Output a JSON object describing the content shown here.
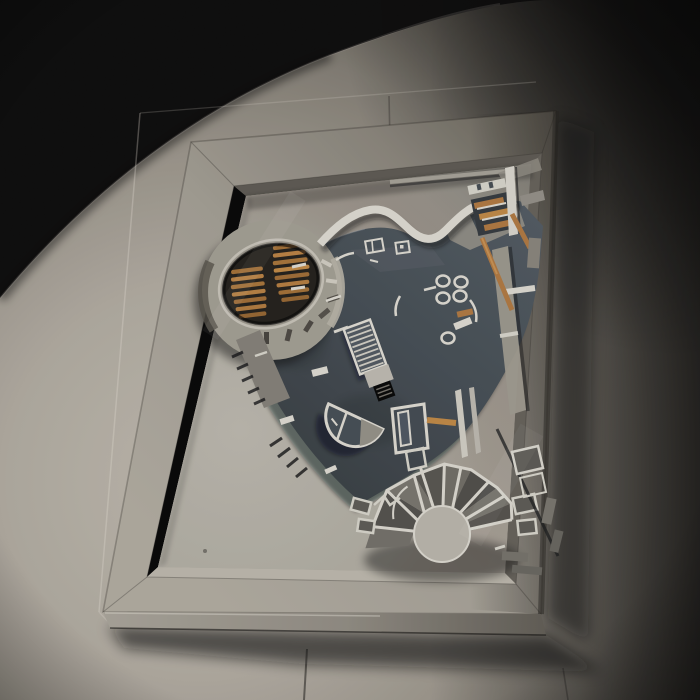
{
  "scene": {
    "type": "photograph",
    "subject": "architectural-scale-model-in-wall-mounted-display-case",
    "lighting": "single-spotlight-from-lower-left-dark-room"
  },
  "palette": {
    "bg": "#060505",
    "wall_bright": "#b7b1a6",
    "wall_mid": "#958f85",
    "wall_dark": "#161412",
    "frame_face": "#a9a499",
    "frame_face_dark": "#5d594f",
    "frame_bottom": "#9a958b",
    "bevel_light": "#b5b0a5",
    "bevel_dark": "#57534c",
    "mat_bright": "#b4b0a6",
    "mat_dark": "#7e7a72",
    "plate": "#3f474e",
    "plate_light": "#4b545c",
    "plate_dark": "#31373c",
    "model_white": "#d6d3ca",
    "model_gray": "#8b887f",
    "fan_gray": "#6c6963",
    "fan_dark": "#4c4a46",
    "orange": "#a8713a",
    "orange_bright": "#b8813f",
    "louver_pit": "#1d1a15",
    "pad_gray": "#9b978c",
    "shadow": "#0a0a0a"
  },
  "counts": {
    "louver_slats_left": 7,
    "louver_slats_right": 8,
    "fan_walls": 9,
    "stair_treads": 9
  }
}
